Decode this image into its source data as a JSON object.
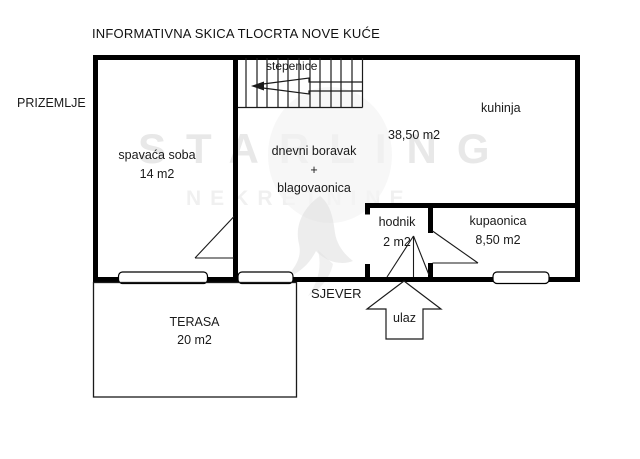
{
  "title": "INFORMATIVNA SKICA TLOCRTA NOVE KUĆE",
  "floor_label": "PRIZEMLJE",
  "compass_label": "SJEVER",
  "watermark": {
    "line1": "STARLING",
    "line2": "NEKRETNINE"
  },
  "rooms": {
    "stairs": {
      "label": "stepenice"
    },
    "kitchen": {
      "label": "kuhinja"
    },
    "living_dining": {
      "line1": "dnevni boravak",
      "line2": "+",
      "line3": "blagovaonica",
      "size": "38,50 m2"
    },
    "bedroom": {
      "label": "spavaća soba",
      "size": "14 m2"
    },
    "hallway": {
      "label": "hodnik",
      "size": "2 m2"
    },
    "bathroom": {
      "label": "kupaonica",
      "size": "8,50 m2"
    },
    "terrace": {
      "label": "TERASA",
      "size": "20 m2"
    },
    "entrance": {
      "label": "ulaz"
    }
  },
  "colors": {
    "wall": "#000000",
    "thin_line": "#1a1a1a",
    "text": "#1a1a1a",
    "watermark_gray": "#e3e3e3",
    "background": "#ffffff"
  }
}
